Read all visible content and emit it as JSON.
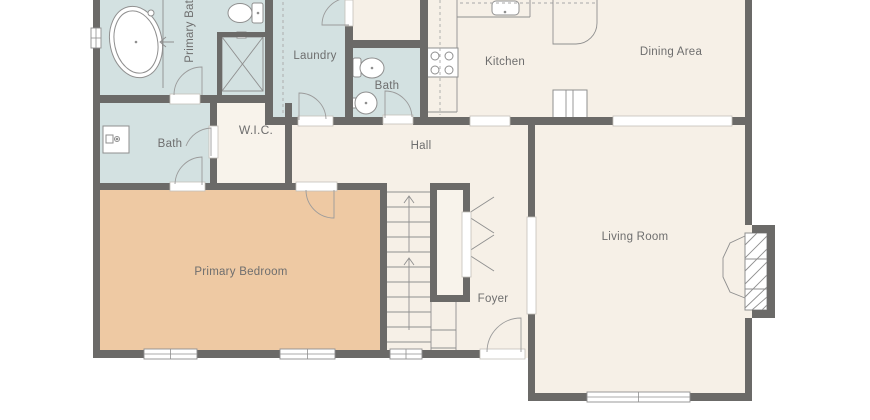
{
  "floorplan": {
    "labels": {
      "primary_bath": "Primary Bath",
      "laundry": "Laundry",
      "bath_top": "Bath",
      "kitchen": "Kitchen",
      "dining": "Dining Area",
      "bath_left": "Bath",
      "wic": "W.I.C.",
      "hall": "Hall",
      "bedroom": "Primary Bedroom",
      "foyer": "Foyer",
      "living": "Living Room"
    },
    "colors": {
      "background": "#ffffff",
      "wall": "#6b6a68",
      "wet": "#d3e1e1",
      "floor": "#f6f0e7",
      "wic": "#f8f3eb",
      "bedroom": "#eec9a3",
      "stroke": "#8f8f8f",
      "door": "#9b9b9b",
      "dash": "#a8a8a8",
      "jamb_stroke": "#c4c0ba",
      "label": "#6e6e6e"
    },
    "geometry": {
      "floors": [
        {
          "n": "hall-foyer-floor",
          "x": 93,
          "y": 95,
          "w": 440,
          "h": 263,
          "f": "floor"
        },
        {
          "n": "hall-stub-floor",
          "x": 345,
          "y": 0,
          "w": 83,
          "h": 48,
          "f": "floor"
        },
        {
          "n": "wic-floor",
          "x": 210,
          "y": 103,
          "w": 82,
          "h": 87,
          "f": "wic"
        },
        {
          "n": "primary-bath-floor",
          "x": 100,
          "y": 0,
          "w": 173,
          "h": 103,
          "f": "wet"
        },
        {
          "n": "laundry-floor",
          "x": 265,
          "y": 0,
          "w": 88,
          "h": 122,
          "f": "wet"
        },
        {
          "n": "bath-top-floor",
          "x": 345,
          "y": 40,
          "w": 83,
          "h": 82,
          "f": "wet"
        },
        {
          "n": "bath-left-floor",
          "x": 100,
          "y": 103,
          "w": 117,
          "h": 87,
          "f": "wet"
        },
        {
          "n": "kitchen-dining-floor",
          "x": 420,
          "y": 0,
          "w": 332,
          "h": 125,
          "f": "floor"
        },
        {
          "n": "bedroom-floor",
          "x": 100,
          "y": 183,
          "w": 287,
          "h": 175,
          "f": "bedroom"
        },
        {
          "n": "living-floor",
          "x": 528,
          "y": 117,
          "w": 224,
          "h": 284,
          "f": "floor"
        }
      ],
      "walls": [
        [
          93,
          0,
          7,
          28
        ],
        [
          93,
          48,
          7,
          310
        ],
        [
          96,
          350,
          48,
          8
        ],
        [
          197,
          350,
          83,
          8
        ],
        [
          335,
          350,
          55,
          8
        ],
        [
          422,
          350,
          58,
          8
        ],
        [
          96,
          95,
          74,
          8
        ],
        [
          200,
          95,
          65,
          8
        ],
        [
          265,
          0,
          8,
          125
        ],
        [
          217,
          32,
          48,
          5
        ],
        [
          217,
          32,
          5,
          66
        ],
        [
          345,
          25,
          8,
          23
        ],
        [
          345,
          40,
          83,
          8
        ],
        [
          345,
          48,
          8,
          74
        ],
        [
          420,
          0,
          8,
          125
        ],
        [
          265,
          117,
          33,
          8
        ],
        [
          333,
          117,
          50,
          8
        ],
        [
          413,
          117,
          57,
          8
        ],
        [
          510,
          117,
          103,
          8
        ],
        [
          732,
          117,
          20,
          8
        ],
        [
          528,
          122,
          7,
          96
        ],
        [
          528,
          313,
          7,
          88
        ],
        [
          528,
          393,
          59,
          8
        ],
        [
          690,
          393,
          62,
          8
        ],
        [
          745,
          0,
          7,
          225
        ],
        [
          745,
          318,
          7,
          83
        ],
        [
          752,
          225,
          23,
          8
        ],
        [
          767,
          225,
          8,
          93
        ],
        [
          752,
          310,
          23,
          8
        ],
        [
          210,
          103,
          7,
          24
        ],
        [
          210,
          157,
          7,
          26
        ],
        [
          285,
          103,
          7,
          87
        ],
        [
          93,
          183,
          77,
          7
        ],
        [
          205,
          183,
          91,
          7
        ],
        [
          337,
          183,
          50,
          7
        ],
        [
          380,
          183,
          7,
          167
        ],
        [
          430,
          183,
          40,
          7
        ],
        [
          430,
          183,
          7,
          119
        ],
        [
          430,
          295,
          40,
          7
        ],
        [
          463,
          183,
          7,
          30
        ],
        [
          463,
          276,
          7,
          26
        ]
      ],
      "jambs": [
        [
          170,
          94,
          30,
          10
        ],
        [
          209,
          126,
          9,
          32
        ],
        [
          170,
          182,
          35,
          9
        ],
        [
          296,
          182,
          41,
          9
        ],
        [
          298,
          116,
          35,
          10
        ],
        [
          383,
          115,
          30,
          9
        ],
        [
          480,
          349,
          45,
          10
        ],
        [
          345,
          0,
          8,
          26
        ],
        [
          470,
          116,
          40,
          10
        ],
        [
          613,
          116,
          119,
          10
        ],
        [
          527,
          217,
          9,
          97
        ],
        [
          462,
          212,
          9,
          65
        ]
      ],
      "windows": [
        {
          "n": "primary-bath-window",
          "x": 91,
          "y": 28,
          "w": 10,
          "h": 20,
          "o": "v"
        },
        {
          "n": "bedroom-window-1",
          "x": 144,
          "y": 349,
          "w": 53,
          "h": 10,
          "o": "h"
        },
        {
          "n": "bedroom-window-2",
          "x": 280,
          "y": 349,
          "w": 55,
          "h": 10,
          "o": "h"
        },
        {
          "n": "foyer-window",
          "x": 390,
          "y": 349,
          "w": 32,
          "h": 10,
          "o": "h"
        },
        {
          "n": "living-window",
          "x": 587,
          "y": 392,
          "w": 103,
          "h": 10,
          "o": "h"
        }
      ],
      "door_arcs": [
        "M202,95 L202,67 A28,28 0 0 0 174,95",
        "M211,156 L211,128 A28,28 0 0 0 186,146",
        "M202,185 L202,157 A28,28 0 0 0 175,184",
        "M334,190 L334,218 A28,28 0 0 1 306,190",
        "M299,120 L299,93 A27,27 0 0 1 326,119",
        "M385,118 L385,91 A27,27 0 0 1 412,117",
        "M349,25 L322,25 A27,27 0 0 1 349,-2",
        "M521,352 L521,318 A34,34 0 0 0 487,352"
      ],
      "lines": [
        [
          163,
          0,
          163,
          88
        ],
        [
          222,
          37,
          263,
          91
        ],
        [
          263,
          37,
          222,
          91
        ],
        [
          387,
          192,
          431,
          192
        ],
        [
          387,
          207,
          431,
          207
        ],
        [
          387,
          222,
          431,
          222
        ],
        [
          387,
          237,
          431,
          237
        ],
        [
          387,
          252,
          431,
          252
        ],
        [
          387,
          267,
          431,
          267
        ],
        [
          387,
          282,
          431,
          282
        ],
        [
          387,
          297,
          431,
          297
        ],
        [
          387,
          312,
          431,
          312
        ],
        [
          387,
          327,
          431,
          327
        ],
        [
          387,
          342,
          431,
          342
        ],
        [
          431,
          302,
          431,
          350
        ],
        [
          456,
          302,
          456,
          350
        ],
        [
          431,
          330,
          456,
          330
        ],
        [
          431,
          348,
          456,
          348
        ],
        [
          409,
          196,
          409,
          252
        ],
        [
          409,
          258,
          409,
          330
        ],
        [
          494,
          197,
          466,
          215
        ],
        [
          466,
          215,
          494,
          233
        ],
        [
          494,
          235,
          466,
          253
        ],
        [
          466,
          253,
          494,
          271
        ],
        [
          457,
          0,
          457,
          48
        ],
        [
          457,
          77,
          457,
          112
        ],
        [
          428,
          112,
          457,
          112
        ],
        [
          457,
          17,
          530,
          17
        ],
        [
          530,
          0,
          530,
          17
        ],
        [
          566,
          90,
          566,
          118
        ],
        [
          573,
          90,
          573,
          118
        ],
        [
          745,
          259,
          767,
          259
        ],
        [
          745,
          289,
          767,
          289
        ],
        [
          745,
          245,
          757,
          233
        ],
        [
          745,
          258,
          767,
          236
        ],
        [
          745,
          271,
          767,
          249
        ],
        [
          745,
          284,
          767,
          262
        ],
        [
          745,
          297,
          767,
          275
        ],
        [
          745,
          308,
          767,
          287
        ],
        [
          752,
          310,
          767,
          297
        ],
        [
          762,
          310,
          767,
          305
        ]
      ],
      "dashed": [
        [
          440,
          0,
          440,
          115
        ],
        [
          460,
          3,
          595,
          3
        ],
        [
          283,
          2,
          283,
          114
        ]
      ],
      "rects": [
        {
          "n": "closet-interior",
          "x": 437,
          "y": 190,
          "w": 26,
          "h": 105,
          "f": "wic",
          "s": "none"
        },
        {
          "n": "stove",
          "x": 427,
          "y": 48,
          "w": 31,
          "h": 29,
          "f": "#ffffff"
        },
        {
          "n": "kitchen-sink",
          "x": 492,
          "y": 1,
          "w": 27,
          "h": 14,
          "f": "#ffffff",
          "rx": 4
        },
        {
          "n": "fridge-cabinet",
          "x": 553,
          "y": 90,
          "w": 34,
          "h": 28,
          "f": "#ffffff"
        },
        {
          "n": "vanity",
          "x": 103,
          "y": 126,
          "w": 26,
          "h": 27,
          "f": "#ffffff"
        },
        {
          "n": "vanity-soap",
          "x": 106,
          "y": 135,
          "w": 7,
          "h": 8,
          "f": "#ffffff"
        },
        {
          "n": "pb-toilet-tank",
          "x": 252,
          "y": 3,
          "w": 11,
          "h": 20,
          "f": "#ffffff",
          "rx": 2
        },
        {
          "n": "bt-toilet-tank",
          "x": 353,
          "y": 58,
          "w": 8,
          "h": 19,
          "f": "#ffffff",
          "rx": 2
        },
        {
          "n": "bt-sink-shelf",
          "x": 351,
          "y": 98,
          "w": 6,
          "h": 10,
          "f": "#ffffff"
        },
        {
          "n": "shower-box",
          "x": 222,
          "y": 37,
          "w": 41,
          "h": 54,
          "f": "none"
        },
        {
          "n": "shower-valve",
          "x": 237,
          "y": 32,
          "w": 9,
          "h": 6,
          "f": "#ffffff"
        },
        {
          "n": "firebox",
          "x": 745,
          "y": 233,
          "w": 22,
          "h": 77,
          "f": "#ffffff"
        }
      ],
      "ellipses": [
        {
          "n": "tub-outer",
          "cx": 136,
          "cy": 42,
          "rx": 26,
          "ry": 36,
          "rot": -12
        },
        {
          "n": "tub-inner",
          "cx": 136,
          "cy": 42,
          "rx": 21.5,
          "ry": 31.5,
          "rot": -12
        },
        {
          "n": "pb-toilet-bowl",
          "cx": 240,
          "cy": 13,
          "rx": 12,
          "ry": 9.5,
          "rot": 0
        },
        {
          "n": "bt-toilet-bowl",
          "cx": 372,
          "cy": 68,
          "rx": 12,
          "ry": 10,
          "rot": 0
        }
      ],
      "circles": [
        {
          "n": "bt-sink",
          "cx": 366,
          "cy": 103,
          "r": 11
        },
        {
          "n": "burner-1",
          "cx": 435,
          "cy": 56,
          "r": 4
        },
        {
          "n": "burner-2",
          "cx": 449,
          "cy": 56,
          "r": 4
        },
        {
          "n": "burner-3",
          "cx": 435,
          "cy": 70,
          "r": 4
        },
        {
          "n": "burner-4",
          "cx": 449,
          "cy": 70,
          "r": 4
        },
        {
          "n": "vanity-faucet",
          "cx": 117,
          "cy": 139,
          "r": 2.5
        },
        {
          "n": "tub-faucet",
          "cx": 151,
          "cy": 13,
          "r": 3
        }
      ],
      "dots": [
        [
          258,
          13
        ],
        [
          372,
          68
        ],
        [
          366,
          103
        ],
        [
          505,
          12
        ],
        [
          136,
          42
        ],
        [
          117,
          139
        ]
      ],
      "paths": [
        {
          "n": "kitchen-peninsula",
          "d": "M553,0 L553,44 L576,44 A21,21 0 0 0 597,23 L597,0"
        },
        {
          "n": "hearth",
          "d": "M745,236 L730,243 L723,258 L723,277 L730,292 L745,298"
        },
        {
          "n": "stair-arrow-head-1",
          "d": "M404,203 L409,196 L414,203"
        },
        {
          "n": "stair-arrow-head-2",
          "d": "M404,265 L409,258 L414,265"
        },
        {
          "n": "tub-divider-arrow",
          "d": "M174,42 L161,42 M166,37 L160,42 L166,47"
        }
      ]
    }
  }
}
